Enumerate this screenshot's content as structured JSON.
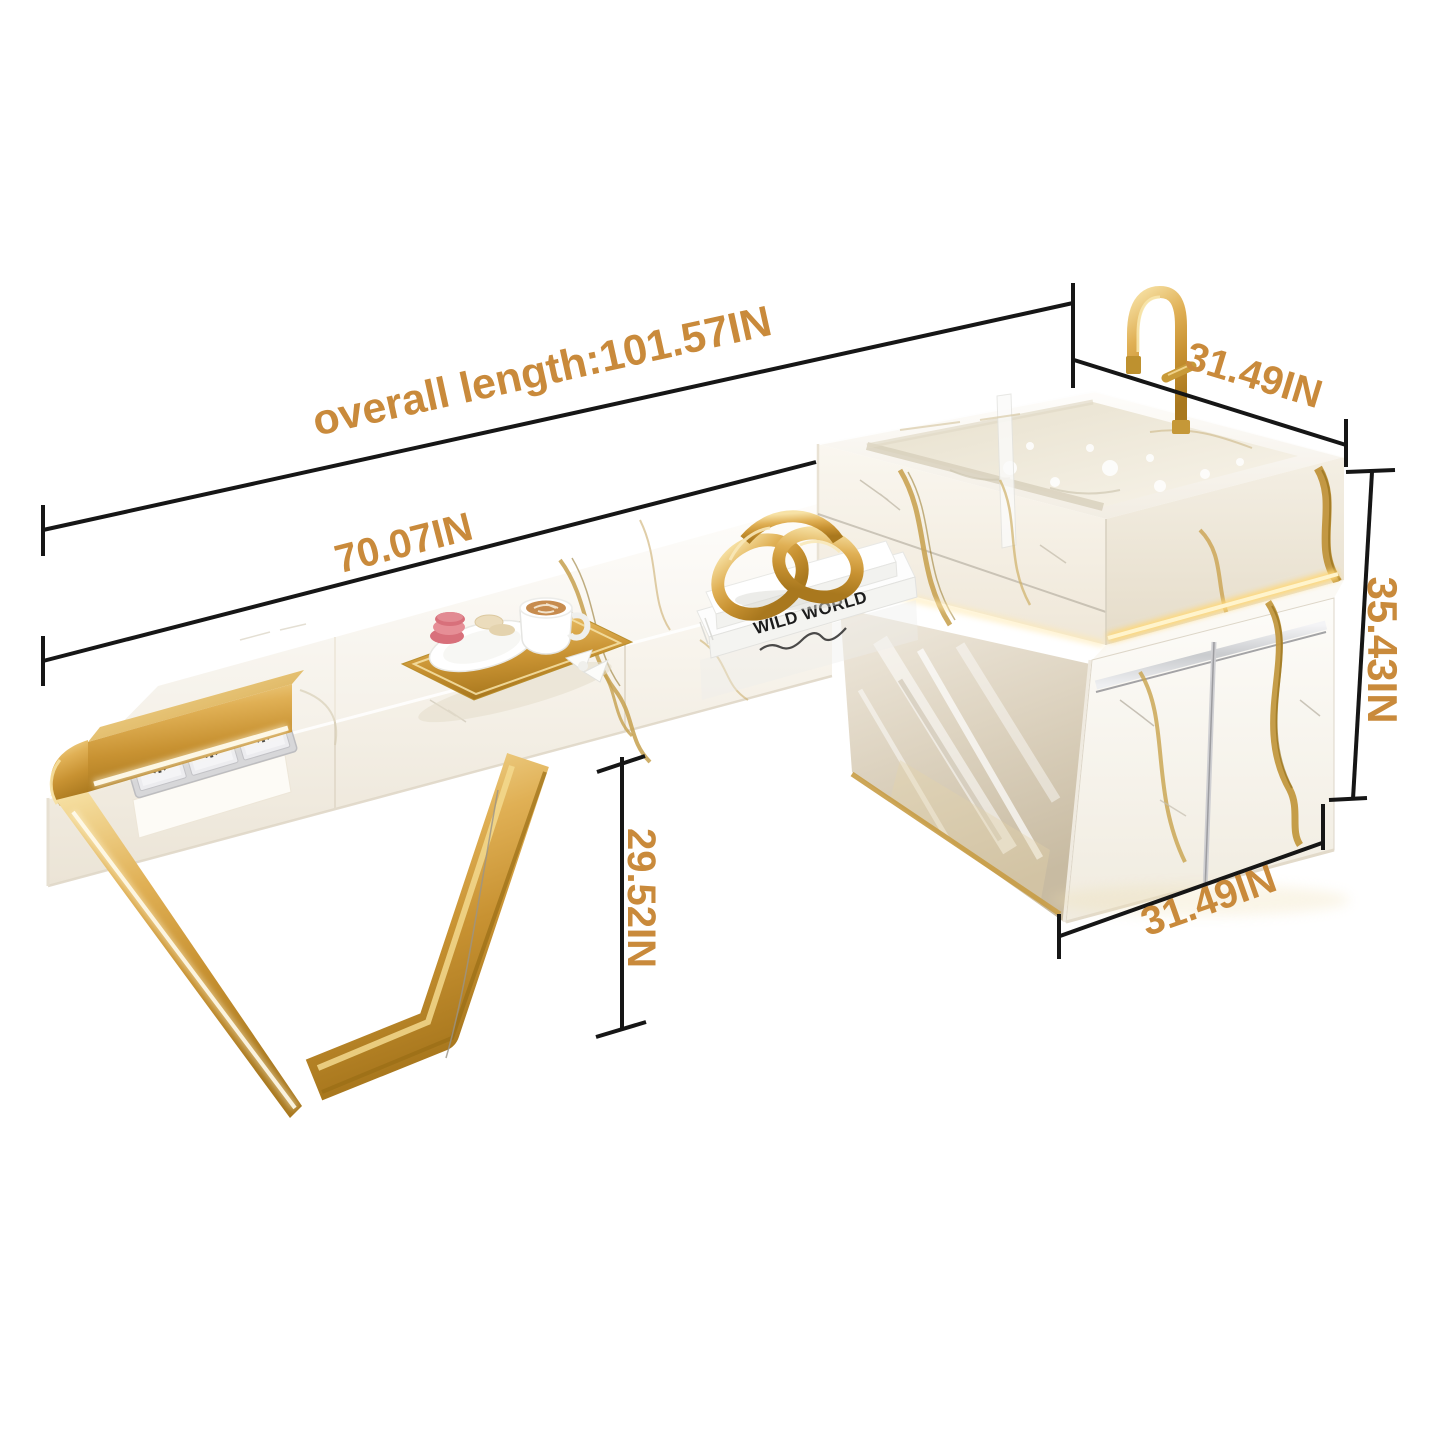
{
  "image_type": "product-dimension-diagram",
  "product": {
    "description": "white marble floating bathroom vanity with vessel sink, gold faucet, gold V-leg and under-sink cabinet",
    "book_spine_text": "WILD WORLD"
  },
  "dimensions": {
    "overall_length": "overall length:101.57IN",
    "countertop_length": "70.07IN",
    "sink_top_depth": "31.49IN",
    "unit_height": "35.43IN",
    "countertop_clearance": "29.52IN",
    "cabinet_width": "31.49IN"
  },
  "colors": {
    "dimension_text": "#C98A3B",
    "dimension_line": "#161616",
    "gold_metal": "#D8AB4E",
    "marble": "#F6F1E7",
    "led_glow": "#FFD878",
    "chrome": "#C9CBCE",
    "background": "#FFFFFF"
  }
}
